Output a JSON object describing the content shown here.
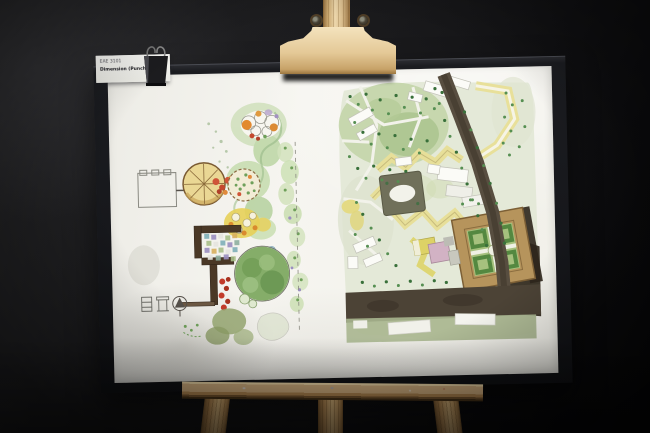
{
  "photo": {
    "label": {
      "line1": "EAE 3101",
      "line2": "Dimension (Punch)",
      "number": "09"
    },
    "colors": {
      "background": "#141416",
      "board_frame": "#17181c",
      "paper": "#f3f2ed",
      "easel_wood": "#d9bc8a",
      "label_number_accent": "#e0771d",
      "watercolor_green": "#85ad69",
      "watercolor_yellow": "#e7df99",
      "road_brown": "#4c4336",
      "fortress_tan": "#b6945c"
    },
    "artwork": {
      "left_drawing": "garden-plan-watercolor-sketch",
      "right_drawing": "urban-site-plan-watercolor-sketch"
    }
  }
}
